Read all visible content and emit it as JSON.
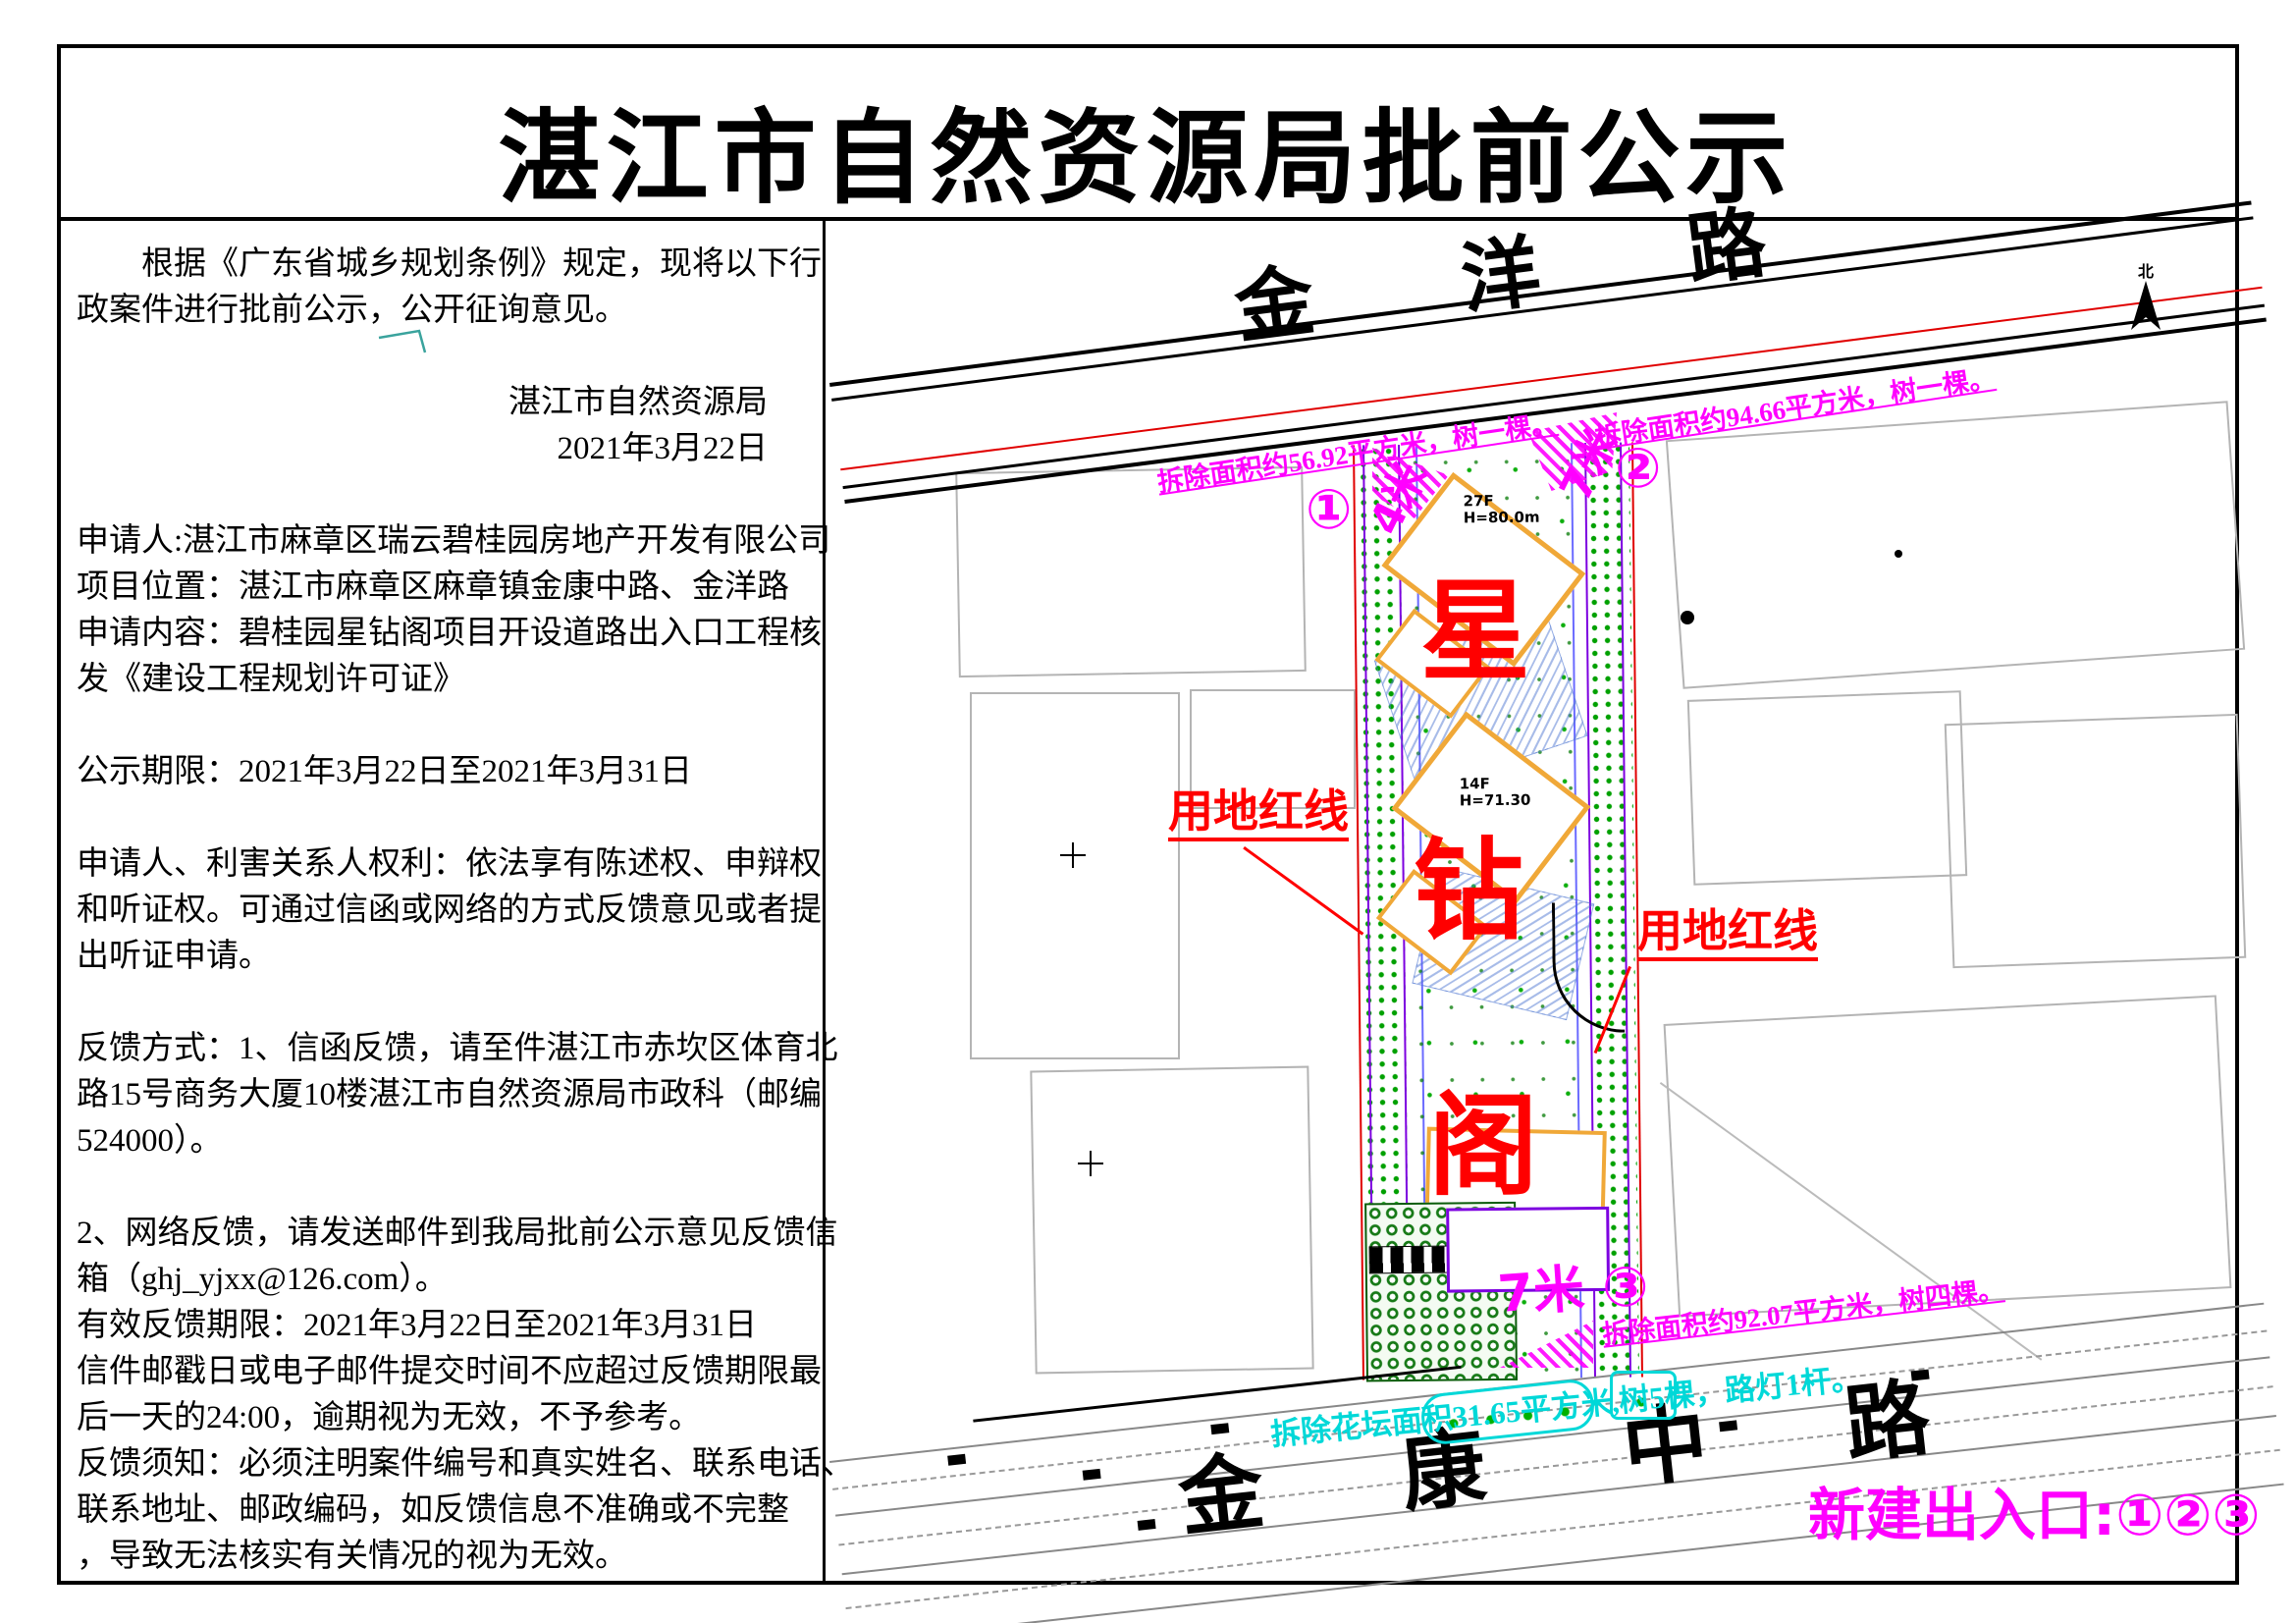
{
  "document": {
    "title": "湛江市自然资源局批前公示"
  },
  "left_column": {
    "lines": [
      {
        "text": "根据《广东省城乡规划条例》规定，现将以下行",
        "indent": true
      },
      {
        "text": "政案件进行批前公示，公开征询意见。"
      },
      {
        "text": ""
      },
      {
        "text": "湛江市自然资源局",
        "align": "right"
      },
      {
        "text": "2021年3月22日",
        "align": "right"
      },
      {
        "text": ""
      },
      {
        "text": "申请人:湛江市麻章区瑞云碧桂园房地产开发有限公司"
      },
      {
        "text": "项目位置：湛江市麻章区麻章镇金康中路、金洋路"
      },
      {
        "text": "申请内容：碧桂园星钻阁项目开设道路出入口工程核"
      },
      {
        "text": "发《建设工程规划许可证》"
      },
      {
        "text": ""
      },
      {
        "text": "公示期限：2021年3月22日至2021年3月31日"
      },
      {
        "text": ""
      },
      {
        "text": "申请人、利害关系人权利：依法享有陈述权、申辩权"
      },
      {
        "text": "和听证权。可通过信函或网络的方式反馈意见或者提"
      },
      {
        "text": "出听证申请。"
      },
      {
        "text": ""
      },
      {
        "text": "反馈方式：1、信函反馈，请至件湛江市赤坎区体育北"
      },
      {
        "text": "路15号商务大厦10楼湛江市自然资源局市政科（邮编"
      },
      {
        "text": "524000）。"
      },
      {
        "text": ""
      },
      {
        "text": "2、网络反馈，请发送邮件到我局批前公示意见反馈信"
      },
      {
        "text": "箱（ghj_yjxx@126.com）。"
      },
      {
        "text": "有效反馈期限：2021年3月22日至2021年3月31日"
      },
      {
        "text": "信件邮戳日或电子邮件提交时间不应超过反馈期限最"
      },
      {
        "text": "后一天的24:00，逾期视为无效，不予参考。"
      },
      {
        "text": "反馈须知：必须注明案件编号和真实姓名、联系电话、"
      },
      {
        "text": "联系地址、邮政编码，如反馈信息不准确或不完整"
      },
      {
        "text": "，导致无法核实有关情况的视为无效。"
      }
    ]
  },
  "map": {
    "north_label": "北",
    "roads": {
      "top": "金 洋 路",
      "bottom": "金 康 中 路"
    },
    "site_name": {
      "chars": [
        "星",
        "钻",
        "阁"
      ]
    },
    "boundary_labels": {
      "left": "用地红线",
      "right": "用地红线"
    },
    "entrances": [
      {
        "num": "①",
        "width_label": "4米"
      },
      {
        "num": "②",
        "width_label": "7米"
      },
      {
        "num": "③",
        "width_label": "7米"
      }
    ],
    "demolition_notes": {
      "top_left": "拆除面积约56.92平方米，树一棵。",
      "top_right": "拆除面积约94.66平方米，树一棵。",
      "bottom": "拆除面积约92.07平方米，树四棵。",
      "flowerbed": "拆除花坛面积31.65平方米,树5棵，路灯1杆。"
    },
    "buildings": [
      {
        "floors": "27F",
        "height": "H=80.0m"
      },
      {
        "floors": "14F",
        "height": "H=71.30"
      }
    ],
    "note_new_entrances": "新建出入口:①②③",
    "colors": {
      "annotation_magenta": "#ff00ff",
      "boundary_red": "#ff0000",
      "site_name_red": "#ff0000",
      "flowerbed_cyan": "#00d8d8",
      "greenbelt_green": "#00a000",
      "building_orange": "#f0a838",
      "utility_purple": "#7d00e0"
    }
  }
}
